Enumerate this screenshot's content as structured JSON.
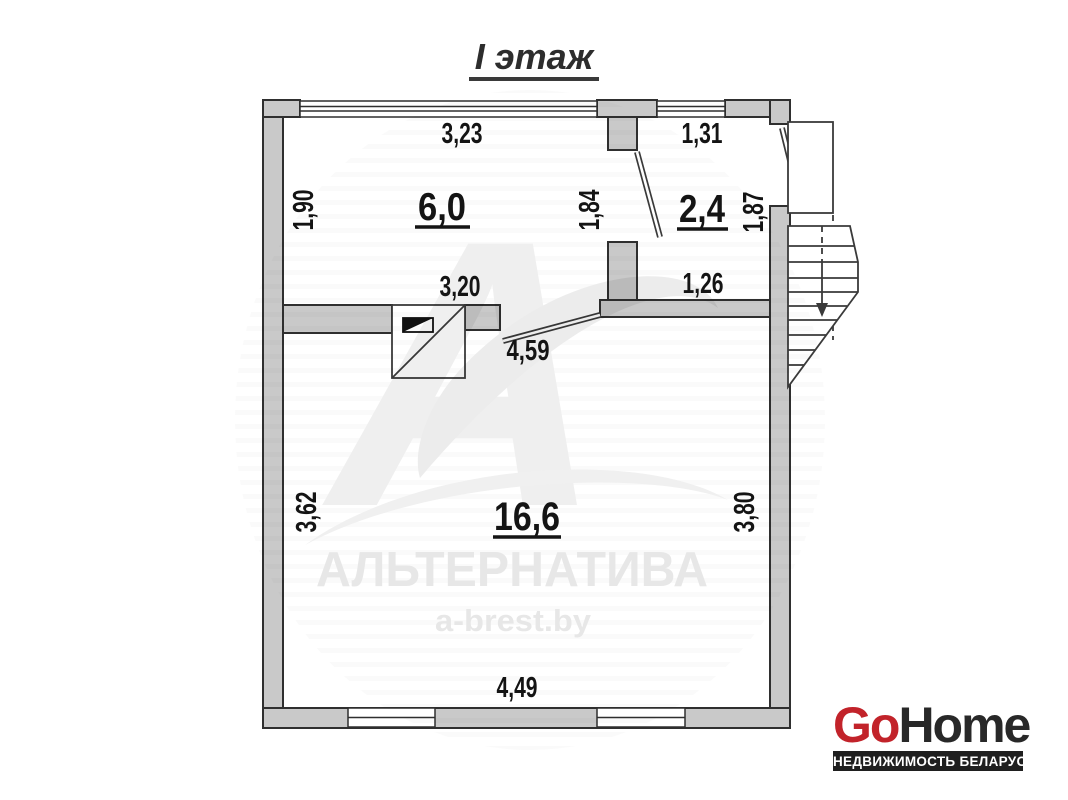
{
  "title": "I этаж",
  "rooms": [
    {
      "label": "6,0",
      "dim_top": "3,23",
      "dim_left": "1,90",
      "dim_right": "1,84",
      "dim_bottom": "3,20"
    },
    {
      "label": "2,4",
      "dim_top": "1,31",
      "dim_right": "1,87",
      "dim_bottom": "1,26"
    },
    {
      "label": "16,6",
      "dim_left": "3,62",
      "dim_right": "3,80",
      "dim_bottom": "4,49",
      "dim_opening": "4,59"
    }
  ],
  "watermark": {
    "brand": "АЛЬТЕРНАТИВА",
    "site": "a-brest.by"
  },
  "logo": {
    "go": "Go",
    "home": "Home",
    "tagline": "НЕДВИЖИМОСТЬ БЕЛАРУСИ"
  },
  "colors": {
    "wall_fill": "#c9c9c9",
    "wall_outline": "#2f2f2f",
    "dim_text": "#141414",
    "watermark_gray": "#e7e7e7",
    "logo_red": "#c2232a",
    "logo_dark": "#282828",
    "tagline_bg": "#1f1f1f",
    "tagline_text": "#ffffff"
  }
}
